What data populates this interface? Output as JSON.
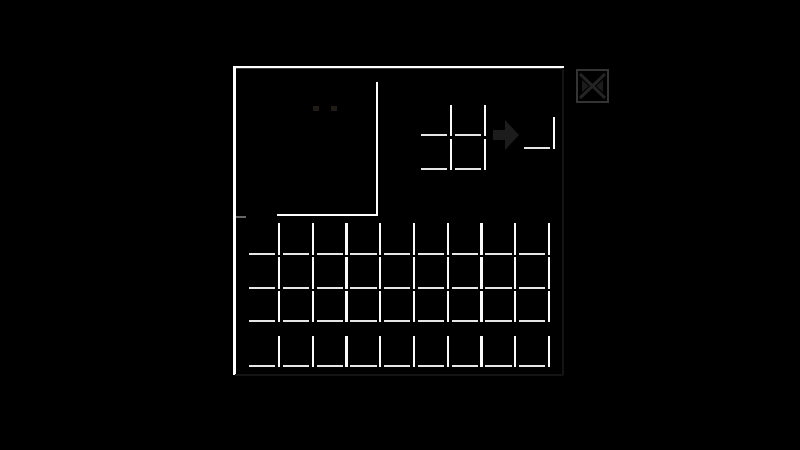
{
  "colors": {
    "background": "#000000",
    "panel_highlight": "#ffffff",
    "slot_highlight_v": "#fbfbfb",
    "slot_highlight_h": "#e6e6e6",
    "panel_shadow": "#141414",
    "faint_icon": "#1c1c1c",
    "square_border": "#343434",
    "square_cross": "#242424",
    "square_fill": "#1c1c1c",
    "eye": "#1f1b15"
  },
  "grids": {
    "crafting": {
      "rows": 2,
      "cols": 2,
      "filled_slots": 0
    },
    "result": {
      "count": 1,
      "filled_slots": 0
    },
    "main": {
      "rows": 3,
      "cols": 9,
      "filled_slots": 0
    },
    "hotbar": {
      "rows": 1,
      "cols": 9,
      "filled_slots": 0
    }
  },
  "icons": {
    "crafting_arrow": "right-arrow-icon",
    "corner_square": "x-pattern-icon"
  },
  "player_preview": {
    "visible_features": "two faint eyes",
    "eye_count": 2
  }
}
